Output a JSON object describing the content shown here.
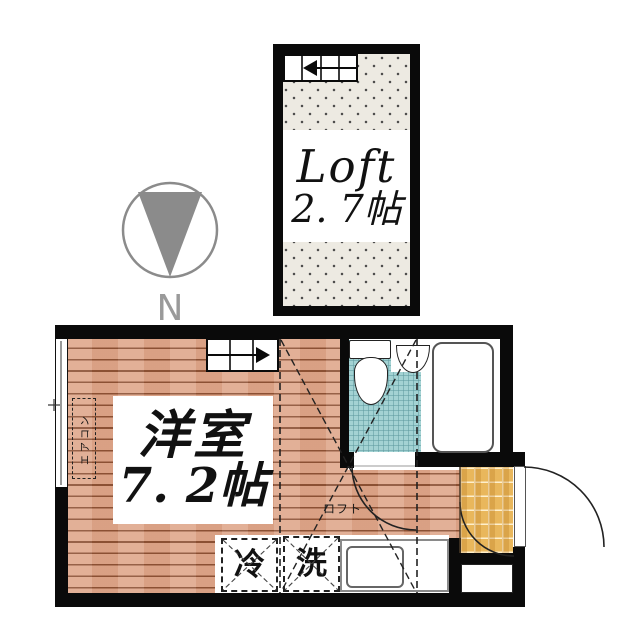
{
  "floorplan": {
    "loft": {
      "label": "Loft",
      "size": "2. 7帖"
    },
    "compass": {
      "north_label": "N"
    },
    "main_room": {
      "name": "洋室",
      "size": "7. 2帖"
    },
    "labels": {
      "air_conditioner": "エアコン",
      "loft_above": "ロフト",
      "refrigerator": "冷",
      "washing_machine": "洗"
    },
    "colors": {
      "wall": "#0a0a0a",
      "wood_floor": "#dfa78b",
      "wood_plank_line": "#8a4f33",
      "entry_tile": "#e9b75c",
      "bathroom_tile": "#a3d2d3",
      "loft_dot_bg": "#edeae2",
      "compass_gray": "#8b8b8b"
    }
  }
}
